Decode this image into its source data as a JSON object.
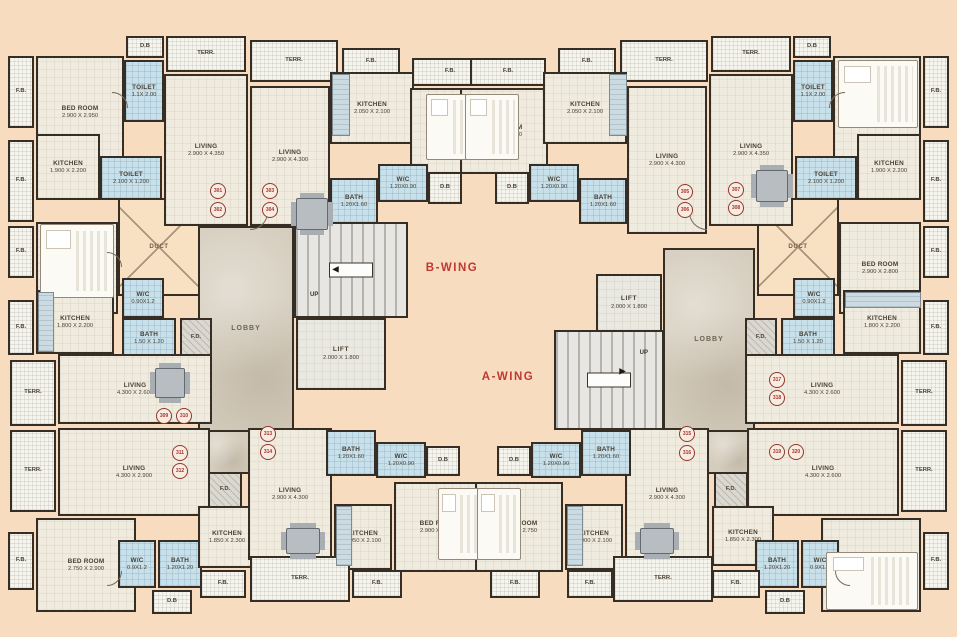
{
  "palette": {
    "page_bg": "#f7dcc0",
    "wall": "#362d24",
    "room_fill": "#f0ebdf",
    "wet_fill": "#c8e0ea",
    "service_fill": "#f5f4ed",
    "lobby_fill": "#d4ccbc",
    "duct_fill": "#f8e0c3",
    "stair_fill": "#e7e6e2",
    "accent_red": "#c0392f"
  },
  "wings": [
    {
      "label": "B-WING",
      "x": 452,
      "y": 268
    },
    {
      "label": "A-WING",
      "x": 508,
      "y": 377
    }
  ],
  "rooms": [
    {
      "n": "DUCT",
      "d": "",
      "x": 118,
      "y": 198,
      "w": 82,
      "h": 98,
      "t": "u"
    },
    {
      "n": "DUCT",
      "d": "",
      "x": 757,
      "y": 198,
      "w": 82,
      "h": 98,
      "t": "u"
    },
    {
      "n": "LOBBY",
      "d": "",
      "x": 198,
      "y": 226,
      "w": 96,
      "h": 206,
      "t": "l"
    },
    {
      "n": "",
      "d": "",
      "x": 198,
      "y": 430,
      "w": 52,
      "h": 44,
      "t": "l"
    },
    {
      "n": "LOBBY",
      "d": "",
      "x": 663,
      "y": 248,
      "w": 92,
      "h": 184,
      "t": "l"
    },
    {
      "n": "",
      "d": "",
      "x": 705,
      "y": 430,
      "w": 50,
      "h": 44,
      "t": "l"
    },
    {
      "n": "LIFT",
      "d": "2.000 X 1.800",
      "x": 296,
      "y": 318,
      "w": 90,
      "h": 72,
      "t": "e"
    },
    {
      "n": "LIFT",
      "d": "2.000 X 1.800",
      "x": 596,
      "y": 274,
      "w": 66,
      "h": 58,
      "t": "e"
    },
    {
      "n": "UP",
      "d": "",
      "x": 294,
      "y": 222,
      "w": 114,
      "h": 96,
      "t": "s",
      "dir": "left"
    },
    {
      "n": "UP",
      "d": "",
      "x": 554,
      "y": 330,
      "w": 110,
      "h": 100,
      "t": "s",
      "dir": "right"
    },
    {
      "n": "F.B.",
      "d": "",
      "x": 8,
      "y": 56,
      "w": 26,
      "h": 72,
      "t": "f"
    },
    {
      "n": "F.B.",
      "d": "",
      "x": 8,
      "y": 140,
      "w": 26,
      "h": 82,
      "t": "f"
    },
    {
      "n": "BED ROOM",
      "d": "2.900 X 2.950",
      "x": 36,
      "y": 56,
      "w": 88,
      "h": 112,
      "t": "r"
    },
    {
      "n": "TOILET",
      "d": "1.1X 2.00",
      "x": 124,
      "y": 60,
      "w": 40,
      "h": 62,
      "t": "w"
    },
    {
      "n": "D.B",
      "d": "",
      "x": 126,
      "y": 36,
      "w": 38,
      "h": 22,
      "t": "d"
    },
    {
      "n": "TERR.",
      "d": "",
      "x": 166,
      "y": 36,
      "w": 80,
      "h": 36,
      "t": "t"
    },
    {
      "n": "LIVING",
      "d": "2.900 X 4.350",
      "x": 164,
      "y": 74,
      "w": 84,
      "h": 152,
      "t": "r"
    },
    {
      "n": "KITCHEN",
      "d": "1.900 X 2.200",
      "x": 36,
      "y": 134,
      "w": 64,
      "h": 66,
      "t": "r"
    },
    {
      "n": "TOILET",
      "d": "2.100 X 1.200",
      "x": 100,
      "y": 156,
      "w": 62,
      "h": 44,
      "t": "w"
    },
    {
      "n": "TERR.",
      "d": "",
      "x": 250,
      "y": 40,
      "w": 88,
      "h": 42,
      "t": "t"
    },
    {
      "n": "F.B.",
      "d": "",
      "x": 342,
      "y": 48,
      "w": 58,
      "h": 28,
      "t": "f"
    },
    {
      "n": "F.B.",
      "d": "",
      "x": 412,
      "y": 58,
      "w": 76,
      "h": 28,
      "t": "f"
    },
    {
      "n": "LIVING",
      "d": "2.900 X 4.300",
      "x": 250,
      "y": 86,
      "w": 80,
      "h": 140,
      "t": "r"
    },
    {
      "n": "KITCHEN",
      "d": "2.050 X 2.100",
      "x": 330,
      "y": 72,
      "w": 84,
      "h": 72,
      "t": "r"
    },
    {
      "n": "BED ROOM",
      "d": "2.900 X 2.700",
      "x": 410,
      "y": 88,
      "w": 88,
      "h": 86,
      "t": "r"
    },
    {
      "n": "BATH",
      "d": "1.20X1.60",
      "x": 330,
      "y": 178,
      "w": 48,
      "h": 46,
      "t": "w"
    },
    {
      "n": "W/C",
      "d": "1.20X0.90",
      "x": 378,
      "y": 164,
      "w": 50,
      "h": 38,
      "t": "w"
    },
    {
      "n": "D.B",
      "d": "",
      "x": 428,
      "y": 172,
      "w": 34,
      "h": 32,
      "t": "d"
    },
    {
      "n": "F.B.",
      "d": "",
      "x": 470,
      "y": 58,
      "w": 76,
      "h": 28,
      "t": "f"
    },
    {
      "n": "F.B.",
      "d": "",
      "x": 558,
      "y": 48,
      "w": 58,
      "h": 28,
      "t": "f"
    },
    {
      "n": "TERR.",
      "d": "",
      "x": 620,
      "y": 40,
      "w": 88,
      "h": 42,
      "t": "t"
    },
    {
      "n": "BED ROOM",
      "d": "2.900 X 2.700",
      "x": 460,
      "y": 88,
      "w": 88,
      "h": 86,
      "t": "r"
    },
    {
      "n": "KITCHEN",
      "d": "2.050 X 2.100",
      "x": 543,
      "y": 72,
      "w": 84,
      "h": 72,
      "t": "r"
    },
    {
      "n": "LIVING",
      "d": "2.900 X 4.300",
      "x": 627,
      "y": 86,
      "w": 80,
      "h": 148,
      "t": "r"
    },
    {
      "n": "D.B",
      "d": "",
      "x": 495,
      "y": 172,
      "w": 34,
      "h": 32,
      "t": "d"
    },
    {
      "n": "W/C",
      "d": "1.20X0.90",
      "x": 529,
      "y": 164,
      "w": 50,
      "h": 38,
      "t": "w"
    },
    {
      "n": "BATH",
      "d": "1.20X1.60",
      "x": 579,
      "y": 178,
      "w": 48,
      "h": 46,
      "t": "w"
    },
    {
      "n": "TERR.",
      "d": "",
      "x": 711,
      "y": 36,
      "w": 80,
      "h": 36,
      "t": "t"
    },
    {
      "n": "D.B",
      "d": "",
      "x": 793,
      "y": 36,
      "w": 38,
      "h": 22,
      "t": "d"
    },
    {
      "n": "TOILET",
      "d": "1.1X 2.00",
      "x": 793,
      "y": 60,
      "w": 40,
      "h": 62,
      "t": "w"
    },
    {
      "n": "BED ROOM",
      "d": "2.900 X 2.950",
      "x": 833,
      "y": 56,
      "w": 88,
      "h": 112,
      "t": "r"
    },
    {
      "n": "F.B.",
      "d": "",
      "x": 923,
      "y": 56,
      "w": 26,
      "h": 72,
      "t": "f"
    },
    {
      "n": "F.B.",
      "d": "",
      "x": 923,
      "y": 140,
      "w": 26,
      "h": 82,
      "t": "f"
    },
    {
      "n": "LIVING",
      "d": "2.900 X 4.350",
      "x": 709,
      "y": 74,
      "w": 84,
      "h": 152,
      "t": "r"
    },
    {
      "n": "KITCHEN",
      "d": "1.900 X 2.200",
      "x": 857,
      "y": 134,
      "w": 64,
      "h": 66,
      "t": "r"
    },
    {
      "n": "TOILET",
      "d": "2.100 X 1.200",
      "x": 795,
      "y": 156,
      "w": 62,
      "h": 44,
      "t": "w"
    },
    {
      "n": "F.B.",
      "d": "",
      "x": 8,
      "y": 226,
      "w": 26,
      "h": 52,
      "t": "f"
    },
    {
      "n": "BED ROOM",
      "d": "2.900 X 2.950",
      "x": 36,
      "y": 222,
      "w": 82,
      "h": 92,
      "t": "r"
    },
    {
      "n": "W/C",
      "d": "0.90X1.2",
      "x": 122,
      "y": 278,
      "w": 42,
      "h": 40,
      "t": "w"
    },
    {
      "n": "F.B.",
      "d": "",
      "x": 8,
      "y": 300,
      "w": 26,
      "h": 55,
      "t": "f"
    },
    {
      "n": "KITCHEN",
      "d": "1.800 X 2.200",
      "x": 36,
      "y": 290,
      "w": 78,
      "h": 64,
      "t": "r"
    },
    {
      "n": "BATH",
      "d": "1.50 X 1.20",
      "x": 122,
      "y": 318,
      "w": 54,
      "h": 40,
      "t": "w"
    },
    {
      "n": "F.D.",
      "d": "",
      "x": 180,
      "y": 318,
      "w": 32,
      "h": 40,
      "t": "x"
    },
    {
      "n": "TERR.",
      "d": "",
      "x": 10,
      "y": 360,
      "w": 46,
      "h": 66,
      "t": "t"
    },
    {
      "n": "LIVING",
      "d": "4.300 X 2.600",
      "x": 58,
      "y": 354,
      "w": 154,
      "h": 70,
      "t": "r"
    },
    {
      "n": "BED ROOM",
      "d": "2.900 X 2.800",
      "x": 839,
      "y": 222,
      "w": 82,
      "h": 92,
      "t": "r"
    },
    {
      "n": "F.B.",
      "d": "",
      "x": 923,
      "y": 226,
      "w": 26,
      "h": 52,
      "t": "f"
    },
    {
      "n": "W/C",
      "d": "0.90X1.2",
      "x": 793,
      "y": 278,
      "w": 42,
      "h": 40,
      "t": "w"
    },
    {
      "n": "KITCHEN",
      "d": "1.800 X 2.200",
      "x": 843,
      "y": 290,
      "w": 78,
      "h": 64,
      "t": "r"
    },
    {
      "n": "F.B.",
      "d": "",
      "x": 923,
      "y": 300,
      "w": 26,
      "h": 55,
      "t": "f"
    },
    {
      "n": "F.D.",
      "d": "",
      "x": 745,
      "y": 318,
      "w": 32,
      "h": 40,
      "t": "x"
    },
    {
      "n": "BATH",
      "d": "1.50 X 1.20",
      "x": 781,
      "y": 318,
      "w": 54,
      "h": 40,
      "t": "w"
    },
    {
      "n": "LIVING",
      "d": "4.300 X 2.600",
      "x": 745,
      "y": 354,
      "w": 154,
      "h": 70,
      "t": "r"
    },
    {
      "n": "TERR.",
      "d": "",
      "x": 901,
      "y": 360,
      "w": 46,
      "h": 66,
      "t": "t"
    },
    {
      "n": "TERR.",
      "d": "",
      "x": 10,
      "y": 430,
      "w": 46,
      "h": 82,
      "t": "t"
    },
    {
      "n": "LIVING",
      "d": "4.300 X 2.900",
      "x": 58,
      "y": 428,
      "w": 152,
      "h": 88,
      "t": "r"
    },
    {
      "n": "F.B.",
      "d": "",
      "x": 8,
      "y": 532,
      "w": 26,
      "h": 58,
      "t": "f"
    },
    {
      "n": "BED ROOM",
      "d": "2.750 X 2.900",
      "x": 36,
      "y": 518,
      "w": 100,
      "h": 94,
      "t": "r"
    },
    {
      "n": "W/C",
      "d": "0.9X1.2",
      "x": 118,
      "y": 540,
      "w": 38,
      "h": 48,
      "t": "w"
    },
    {
      "n": "BATH",
      "d": "1.20X1.20",
      "x": 158,
      "y": 540,
      "w": 44,
      "h": 48,
      "t": "w"
    },
    {
      "n": "D.B",
      "d": "",
      "x": 152,
      "y": 590,
      "w": 40,
      "h": 24,
      "t": "d"
    },
    {
      "n": "F.D.",
      "d": "",
      "x": 208,
      "y": 472,
      "w": 34,
      "h": 36,
      "t": "x"
    },
    {
      "n": "KITCHEN",
      "d": "1.850 X 2.300",
      "x": 198,
      "y": 506,
      "w": 58,
      "h": 62,
      "t": "r"
    },
    {
      "n": "LIVING",
      "d": "2.900 X 4.300",
      "x": 248,
      "y": 428,
      "w": 84,
      "h": 132,
      "t": "r"
    },
    {
      "n": "BATH",
      "d": "1.20X1.60",
      "x": 326,
      "y": 430,
      "w": 50,
      "h": 46,
      "t": "w"
    },
    {
      "n": "W/C",
      "d": "1.20X0.90",
      "x": 376,
      "y": 442,
      "w": 50,
      "h": 36,
      "t": "w"
    },
    {
      "n": "D.B",
      "d": "",
      "x": 426,
      "y": 446,
      "w": 34,
      "h": 30,
      "t": "d"
    },
    {
      "n": "KITCHEN",
      "d": "2.050 X 2.100",
      "x": 334,
      "y": 504,
      "w": 58,
      "h": 66,
      "t": "r"
    },
    {
      "n": "BED ROOM",
      "d": "2.900 X 2.750",
      "x": 394,
      "y": 482,
      "w": 88,
      "h": 90,
      "t": "r"
    },
    {
      "n": "TERR.",
      "d": "",
      "x": 250,
      "y": 556,
      "w": 100,
      "h": 46,
      "t": "t"
    },
    {
      "n": "F.B.",
      "d": "",
      "x": 200,
      "y": 570,
      "w": 46,
      "h": 28,
      "t": "f"
    },
    {
      "n": "F.B.",
      "d": "",
      "x": 352,
      "y": 570,
      "w": 50,
      "h": 28,
      "t": "f"
    },
    {
      "n": "BED ROOM",
      "d": "2.900 X 2.750",
      "x": 475,
      "y": 482,
      "w": 88,
      "h": 90,
      "t": "r"
    },
    {
      "n": "KITCHEN",
      "d": "2.000 X 2.100",
      "x": 565,
      "y": 504,
      "w": 58,
      "h": 66,
      "t": "r"
    },
    {
      "n": "LIVING",
      "d": "2.900 X 4.300",
      "x": 625,
      "y": 428,
      "w": 84,
      "h": 132,
      "t": "r"
    },
    {
      "n": "D.B",
      "d": "",
      "x": 497,
      "y": 446,
      "w": 34,
      "h": 30,
      "t": "d"
    },
    {
      "n": "W/C",
      "d": "1.20X0.90",
      "x": 531,
      "y": 442,
      "w": 50,
      "h": 36,
      "t": "w"
    },
    {
      "n": "BATH",
      "d": "1.20X1.60",
      "x": 581,
      "y": 430,
      "w": 50,
      "h": 46,
      "t": "w"
    },
    {
      "n": "F.B.",
      "d": "",
      "x": 490,
      "y": 570,
      "w": 50,
      "h": 28,
      "t": "f"
    },
    {
      "n": "F.B.",
      "d": "",
      "x": 567,
      "y": 570,
      "w": 46,
      "h": 28,
      "t": "f"
    },
    {
      "n": "TERR.",
      "d": "",
      "x": 613,
      "y": 556,
      "w": 100,
      "h": 46,
      "t": "t"
    },
    {
      "n": "F.D.",
      "d": "",
      "x": 714,
      "y": 472,
      "w": 34,
      "h": 36,
      "t": "x"
    },
    {
      "n": "LIVING",
      "d": "4.300 X 2.600",
      "x": 747,
      "y": 428,
      "w": 152,
      "h": 88,
      "t": "r"
    },
    {
      "n": "TERR.",
      "d": "",
      "x": 901,
      "y": 430,
      "w": 46,
      "h": 82,
      "t": "t"
    },
    {
      "n": "KITCHEN",
      "d": "1.850 X 2.300",
      "x": 712,
      "y": 506,
      "w": 62,
      "h": 60,
      "t": "r"
    },
    {
      "n": "BED ROOM",
      "d": "2.750 X 2.950",
      "x": 821,
      "y": 518,
      "w": 100,
      "h": 94,
      "t": "r"
    },
    {
      "n": "F.B.",
      "d": "",
      "x": 923,
      "y": 532,
      "w": 26,
      "h": 58,
      "t": "f"
    },
    {
      "n": "BATH",
      "d": "1.20X1.20",
      "x": 755,
      "y": 540,
      "w": 44,
      "h": 48,
      "t": "w"
    },
    {
      "n": "W/C",
      "d": "0.9X1.2",
      "x": 801,
      "y": 540,
      "w": 38,
      "h": 48,
      "t": "w"
    },
    {
      "n": "D.B",
      "d": "",
      "x": 765,
      "y": 590,
      "w": 40,
      "h": 24,
      "t": "d"
    },
    {
      "n": "F.B.",
      "d": "",
      "x": 712,
      "y": 570,
      "w": 48,
      "h": 28,
      "t": "f"
    }
  ],
  "badges": [
    {
      "t": "301",
      "x": 218,
      "y": 191
    },
    {
      "t": "302",
      "x": 218,
      "y": 210
    },
    {
      "t": "303",
      "x": 270,
      "y": 191
    },
    {
      "t": "304",
      "x": 270,
      "y": 210
    },
    {
      "t": "305",
      "x": 685,
      "y": 192
    },
    {
      "t": "306",
      "x": 685,
      "y": 210
    },
    {
      "t": "307",
      "x": 736,
      "y": 190
    },
    {
      "t": "308",
      "x": 736,
      "y": 208
    },
    {
      "t": "309",
      "x": 164,
      "y": 416
    },
    {
      "t": "310",
      "x": 184,
      "y": 416
    },
    {
      "t": "311",
      "x": 180,
      "y": 453
    },
    {
      "t": "312",
      "x": 180,
      "y": 471
    },
    {
      "t": "313",
      "x": 268,
      "y": 434
    },
    {
      "t": "314",
      "x": 268,
      "y": 452
    },
    {
      "t": "315",
      "x": 687,
      "y": 434
    },
    {
      "t": "316",
      "x": 687,
      "y": 453
    },
    {
      "t": "317",
      "x": 777,
      "y": 380
    },
    {
      "t": "318",
      "x": 777,
      "y": 398
    },
    {
      "t": "319",
      "x": 777,
      "y": 452
    },
    {
      "t": "320",
      "x": 796,
      "y": 452
    }
  ],
  "furniture": {
    "beds": [
      {
        "x": 838,
        "y": 60,
        "w": 78,
        "h": 66
      },
      {
        "x": 40,
        "y": 224,
        "w": 72,
        "h": 72
      },
      {
        "x": 426,
        "y": 94,
        "w": 52,
        "h": 64
      },
      {
        "x": 465,
        "y": 94,
        "w": 52,
        "h": 64
      },
      {
        "x": 438,
        "y": 488,
        "w": 42,
        "h": 70
      },
      {
        "x": 477,
        "y": 488,
        "w": 42,
        "h": 70
      },
      {
        "x": 826,
        "y": 552,
        "w": 90,
        "h": 56
      }
    ],
    "tables": [
      {
        "x": 296,
        "y": 198,
        "w": 30,
        "h": 30
      },
      {
        "x": 756,
        "y": 170,
        "w": 30,
        "h": 30
      },
      {
        "x": 155,
        "y": 368,
        "w": 28,
        "h": 28
      },
      {
        "x": 286,
        "y": 528,
        "w": 32,
        "h": 24
      },
      {
        "x": 640,
        "y": 528,
        "w": 32,
        "h": 24
      }
    ],
    "counters": [
      {
        "x": 332,
        "y": 74,
        "w": 16,
        "h": 60
      },
      {
        "x": 609,
        "y": 74,
        "w": 16,
        "h": 60
      },
      {
        "x": 336,
        "y": 506,
        "w": 14,
        "h": 58
      },
      {
        "x": 567,
        "y": 506,
        "w": 14,
        "h": 58
      },
      {
        "x": 845,
        "y": 292,
        "w": 74,
        "h": 14
      },
      {
        "x": 38,
        "y": 292,
        "w": 14,
        "h": 58
      }
    ]
  },
  "arcs": [
    {
      "x": 96,
      "y": 92,
      "w": 32,
      "h": 32,
      "q": "tr"
    },
    {
      "x": 829,
      "y": 92,
      "w": 32,
      "h": 32,
      "q": "tl"
    },
    {
      "x": 232,
      "y": 194,
      "w": 36,
      "h": 36,
      "q": "br"
    },
    {
      "x": 689,
      "y": 194,
      "w": 36,
      "h": 36,
      "q": "bl"
    },
    {
      "x": 92,
      "y": 252,
      "w": 30,
      "h": 30,
      "q": "tr"
    },
    {
      "x": 92,
      "y": 556,
      "w": 30,
      "h": 30,
      "q": "br"
    },
    {
      "x": 835,
      "y": 556,
      "w": 30,
      "h": 30,
      "q": "bl"
    }
  ]
}
